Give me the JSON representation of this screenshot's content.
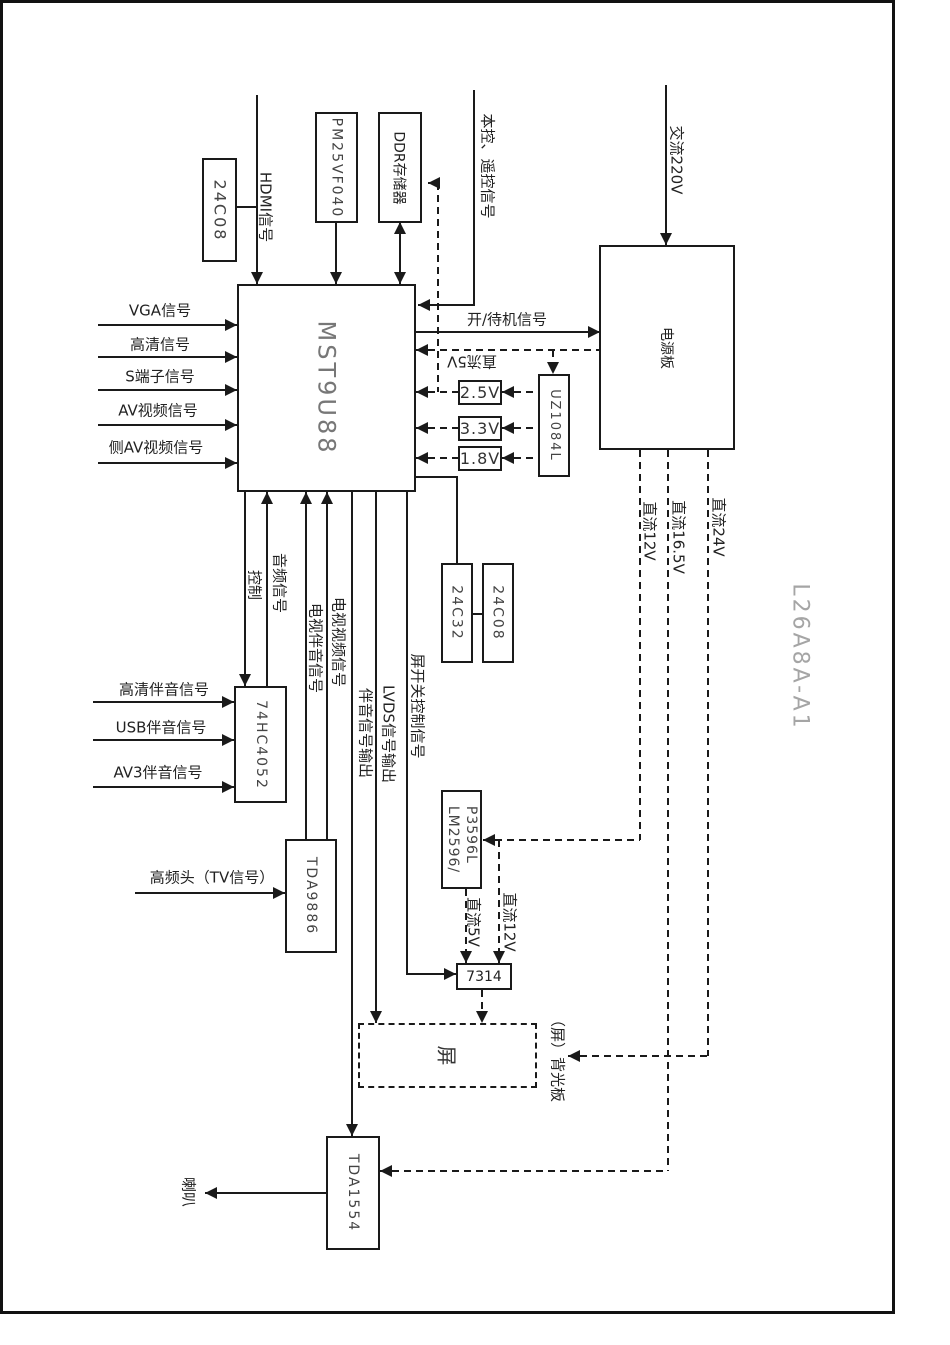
{
  "page": {
    "model_number": "L26A8A-A1"
  },
  "colors": {
    "ink": "#1a1a1a",
    "model_text": "#a5a5a5",
    "background": "#ffffff"
  },
  "chips": {
    "eeprom_top": "24C08",
    "flash": "PM25VF040",
    "ddr": "DDR存储器",
    "main": "MST9U88",
    "power_board": "电源板",
    "ldo": "UZ1084L",
    "rail_2v5": "2.5V",
    "rail_3v3": "3.3V",
    "rail_1v8": "1.8V",
    "eeprom_24c32": "24C32",
    "eeprom_24c08": "24C08",
    "audio_switch": "74HC4052",
    "if_demod": "TDA9886",
    "dcdc_line1": "LM2596/",
    "dcdc_line2": "P3596L",
    "panel_ic": "7314",
    "panel": "屏",
    "audio_amp": "TDA1554"
  },
  "signals": {
    "hdmi": "HDMI信号",
    "local_remote": "本控、遥控信号",
    "ac220": "交流220V",
    "vga": "VGA信号",
    "hd": "高清信号",
    "svideo": "S端子信号",
    "av": "AV视频信号",
    "side_av": "侧AV视频信号",
    "on_standby": "开/待机信号",
    "standby_5v": "直流5V",
    "control": "控制",
    "audio": "音频信号",
    "tv_audio": "电视伴音信号",
    "tv_video": "电视视频信号",
    "audio_out": "伴音信号输出",
    "lvds_out": "LVDS信号输出",
    "panel_switch": "屏开关控制信号",
    "hd_audio": "高清伴音信号",
    "usb_audio": "USB伴音信号",
    "av3_audio": "AV3伴音信号",
    "tuner": "高频头（TV信号）",
    "dc5": "直流5V",
    "dc12_local": "直流12V",
    "dc12": "直流12V",
    "dc16_5": "直流16.5V",
    "dc24": "直流24V",
    "backlight": "（屏）背光板",
    "speaker": "喇叭"
  }
}
